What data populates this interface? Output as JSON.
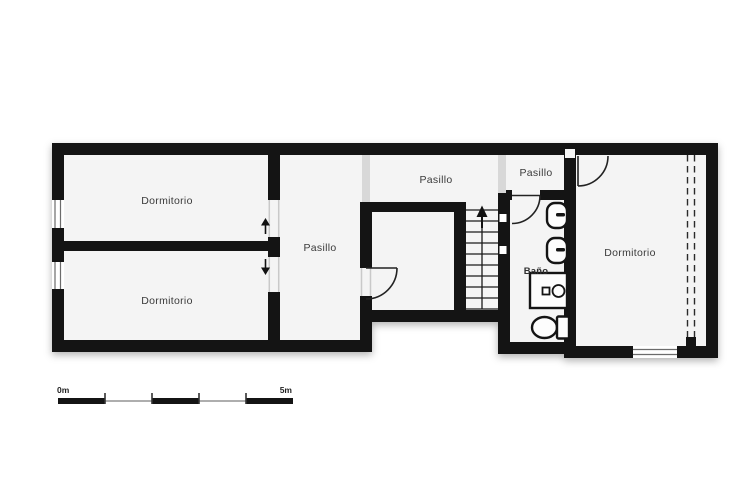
{
  "floor_plan": {
    "rooms": {
      "dormitorio_top_left": "Dormitorio",
      "dormitorio_bottom_left": "Dormitorio",
      "dormitorio_right": "Dormitorio",
      "pasillo_vertical": "Pasillo",
      "pasillo_horizontal": "Pasillo",
      "pasillo_small": "Pasillo",
      "bano": "Baño"
    },
    "stairs": {
      "direction": "up"
    },
    "bathroom_fixtures": [
      "sink",
      "sink",
      "shower",
      "toilet"
    ],
    "scale_bar": {
      "start_label": "0m",
      "end_label": "5m"
    },
    "colors": {
      "wall": "#141414",
      "room_fill": "#f4f4f4",
      "outside": "#ffffff",
      "opening": "#d8d8d8",
      "label_text": "#3a3a3a"
    }
  }
}
